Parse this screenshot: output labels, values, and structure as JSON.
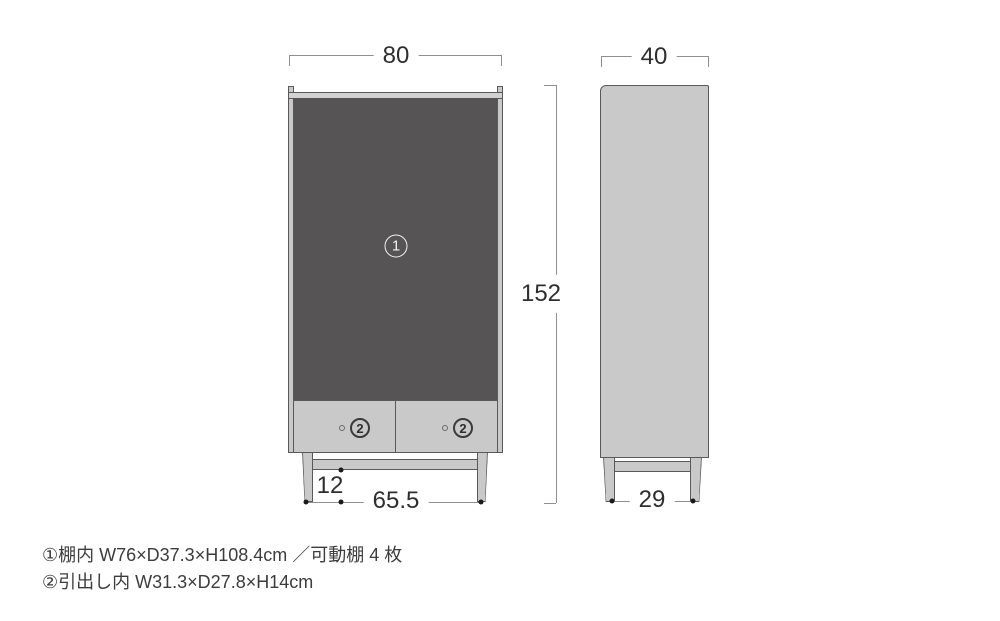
{
  "figure": {
    "type": "furniture-dimension-diagram",
    "units": "cm"
  },
  "front_view": {
    "width_label": "80",
    "height_label": "152",
    "leg_height_label": "12",
    "leg_span_label": "65.5",
    "shelf_marker": "1",
    "drawer_markers": [
      "2",
      "2"
    ]
  },
  "side_view": {
    "depth_label": "40",
    "leg_span_label": "29"
  },
  "footnotes": [
    "①棚内 W76×D37.3×H108.4cm ／可動棚 4 枚",
    "②引出し内 W31.3×D27.8×H14cm"
  ],
  "colors": {
    "background": "#ffffff",
    "cabinet_fill": "#c9c9c9",
    "cabinet_fill_light": "#d2d2d2",
    "cabinet_outline": "#5a5858",
    "interior_dark": "#565455",
    "dimension_line": "#8f8f8f",
    "dimension_text": "#2e2e2e",
    "dot": "#1a1a1a",
    "marker_light": "#f2f2f2",
    "footnote_text": "#3c3c3c"
  }
}
